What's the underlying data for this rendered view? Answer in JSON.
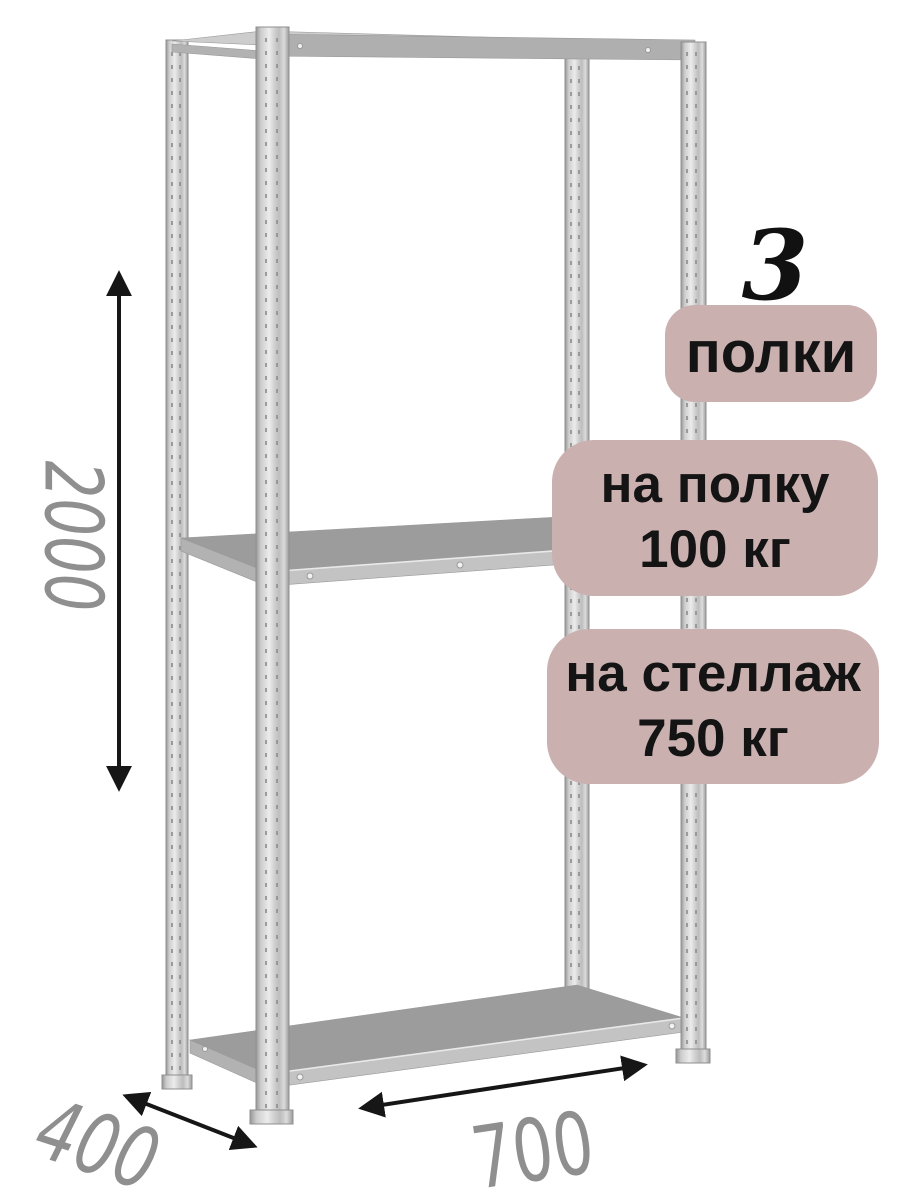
{
  "product_badges": {
    "shelves_count": {
      "value": "3",
      "label": "полки"
    },
    "shelf_load": {
      "line1": "на полку",
      "line2": "100 кг"
    },
    "rack_load": {
      "line1": "на стеллаж",
      "line2": "750 кг"
    }
  },
  "dimensions_mm": {
    "height": "2000",
    "depth": "400",
    "width": "700"
  },
  "colors": {
    "page_background": "#ffffff",
    "badge_background": "#cbb0b0",
    "badge_text": "#141414",
    "count_number_text": "#111111",
    "dimension_label": "#8f8f8f",
    "arrow": "#161616",
    "metal_edge": "#969696",
    "metal_face": "#ececec",
    "shelf_surface": "#9c9c9c",
    "shelf_front_edge": "#c3c3c3",
    "shelf_side_edge": "#b2b2b2",
    "top_shelf_beam": "#afafaf",
    "top_shelf_sliver": "#cdcdcd"
  }
}
